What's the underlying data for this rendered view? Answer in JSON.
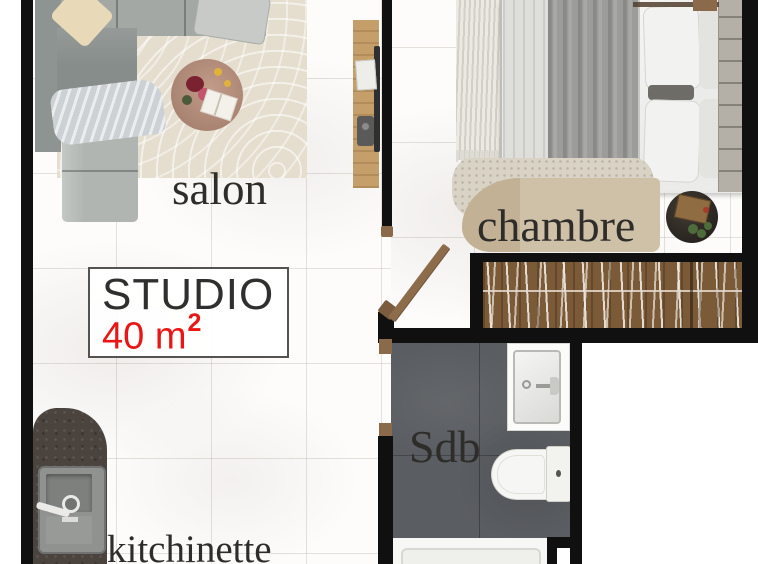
{
  "plan": {
    "title": "STUDIO",
    "area_value": "40 m",
    "area_superscript": "2"
  },
  "rooms": {
    "salon": {
      "label": "salon"
    },
    "chambre": {
      "label": "chambre"
    },
    "sdb": {
      "label": "Sdb"
    },
    "kitchinette": {
      "label": "kitchinette"
    }
  },
  "colors": {
    "wall": "#101010",
    "accent_red": "#ea1515",
    "wood_door": "#8a6a4a",
    "wardrobe_wood": "#7b5a38",
    "bathroom_floor": "#5a5d61",
    "kitchen_counter": "#4a433e",
    "rug_beige": "#e5decf"
  }
}
